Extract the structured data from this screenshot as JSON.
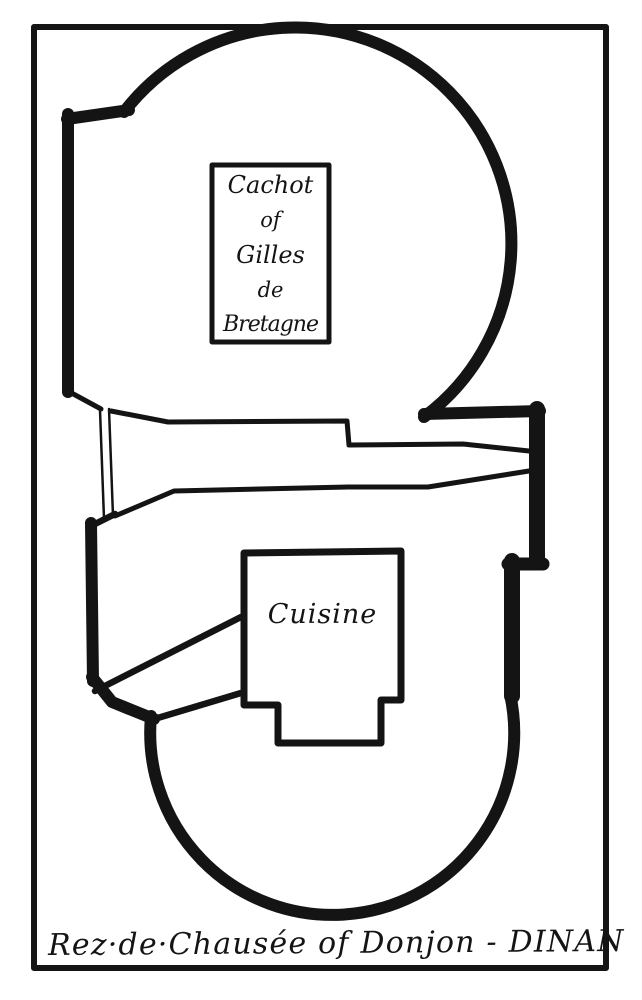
{
  "plan": {
    "caption": "Rez·de·Chausée of Donjon - DINAN",
    "cachot": {
      "lines": [
        "Cachot",
        "of",
        "Gilles",
        "de",
        "Bretagne"
      ]
    },
    "cuisine": {
      "label": "Cuisine"
    },
    "colors": {
      "ink": "#141414",
      "paper": "#ffffff"
    }
  }
}
